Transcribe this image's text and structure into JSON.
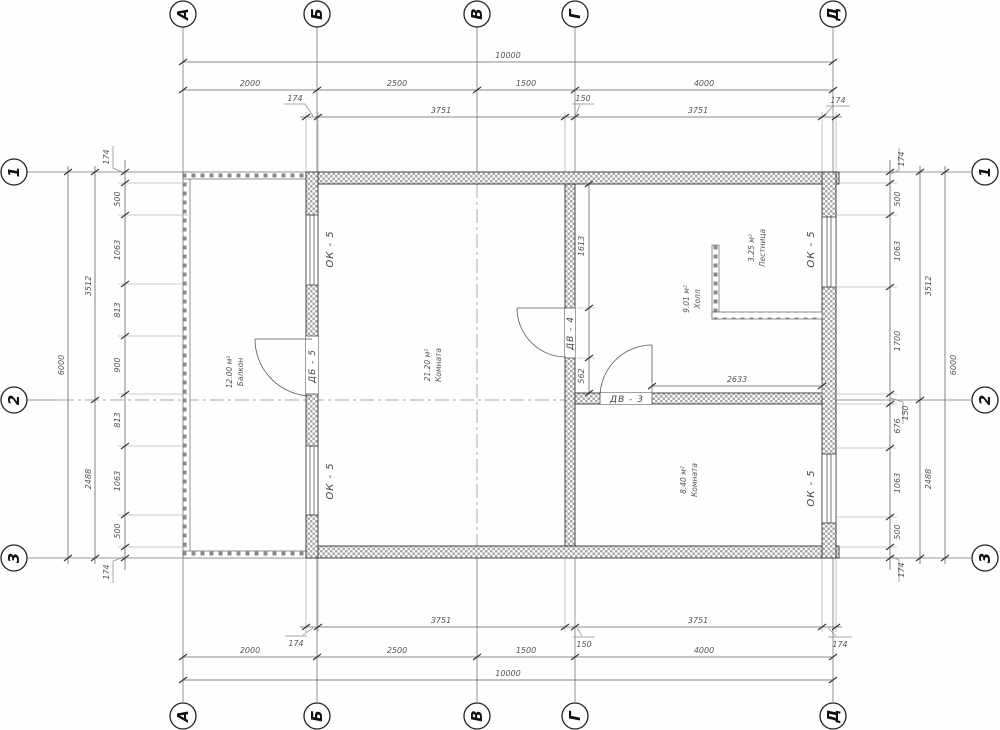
{
  "axes": {
    "cols": [
      "А",
      "Б",
      "В",
      "Г",
      "Д"
    ],
    "rows": [
      "1",
      "2",
      "3"
    ]
  },
  "dims": {
    "top": {
      "overall": "10000",
      "majors": [
        "2000",
        "2500",
        "1500",
        "4000"
      ],
      "minors": [
        "174",
        "3751",
        "150",
        "3751",
        "174"
      ]
    },
    "bottom": {
      "overall": "10000",
      "majors": [
        "2000",
        "2500",
        "1500",
        "4000"
      ],
      "minors": [
        "174",
        "3751",
        "150",
        "3751",
        "174"
      ]
    },
    "left": {
      "overall": "6000",
      "majors": [
        "3512",
        "2488"
      ],
      "minors": [
        "174",
        "500",
        "1063",
        "813",
        "900",
        "813",
        "1063",
        "500",
        "174"
      ]
    },
    "right": {
      "overall": "6000",
      "majors": [
        "3512",
        "2488"
      ],
      "minors": [
        "174",
        "500",
        "1063",
        "1700",
        "150",
        "676",
        "1063",
        "500",
        "174"
      ]
    },
    "inner": {
      "door_top": "1613",
      "door_bottom": "562",
      "hall_width": "2633"
    }
  },
  "rooms": [
    {
      "name": "Балкон",
      "area": "12.00 м²"
    },
    {
      "name": "Комната",
      "area": "21.20 м²"
    },
    {
      "name": "Лестница",
      "area": "3.25 м²"
    },
    {
      "name": "Холл",
      "area": "9.01 м²"
    },
    {
      "name": "Комната",
      "area": "8.40 м²"
    }
  ],
  "openings": {
    "window": "ОК - 5",
    "balcony_door": "ДБ - 5",
    "hall_door": "ДВ - 4",
    "room_door": "ДВ - 3"
  },
  "colors": {
    "line": "#333333",
    "hatch": "#a8a8a8",
    "dim_text": "#555555"
  }
}
